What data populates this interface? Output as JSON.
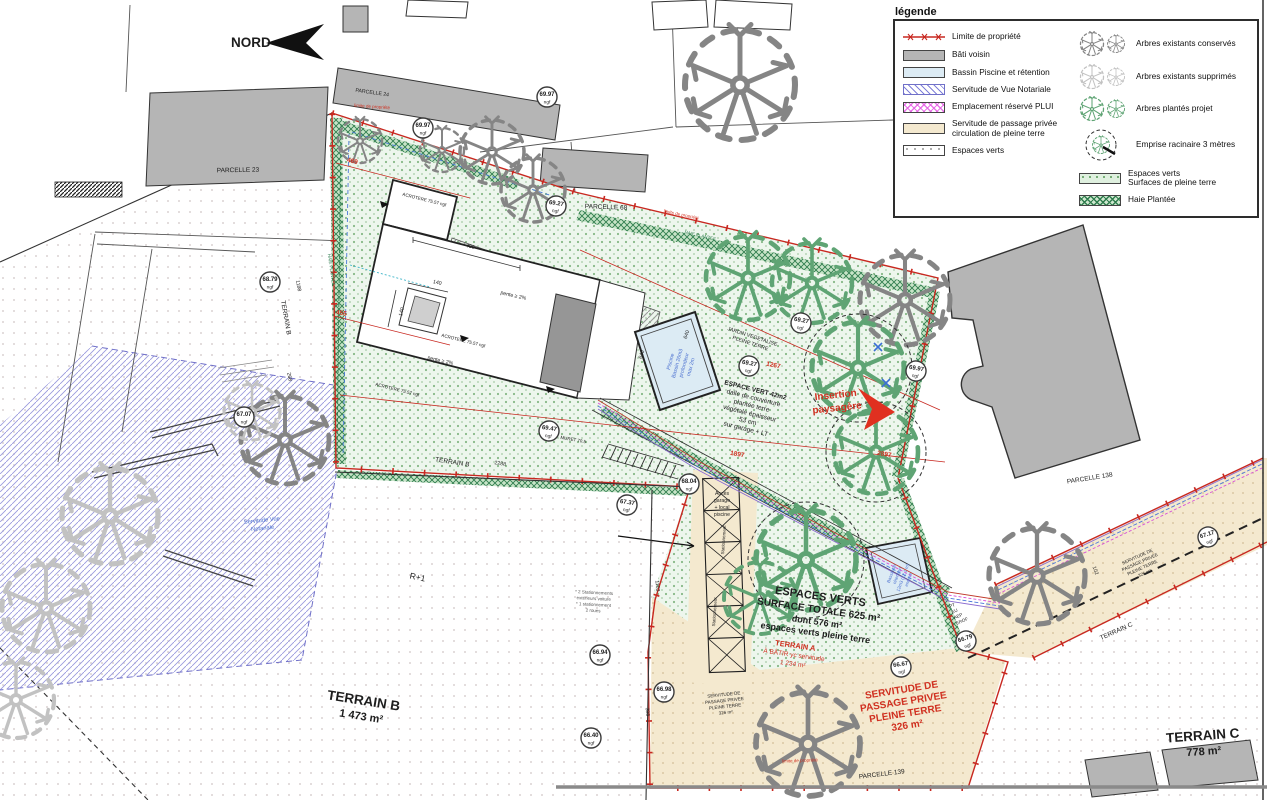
{
  "colors": {
    "boundary": "#c82820",
    "red_text": "#d03020",
    "mint": "#edf6ed",
    "dot_green": "#74ad74",
    "haie": "#2f7d4e",
    "haie_bg": "#c7e4c7",
    "beige": "#f4e9cf",
    "bati": "#b5b5b5",
    "bassin": "#dcebf4",
    "vue": "#8080d0",
    "plui": "#e55ce5",
    "blue_text": "#4a6fd0",
    "dash_blue": "#4a78d8",
    "magenta": "#d84fd8",
    "purple": "#8a6ad0",
    "gray_line": "#555"
  },
  "north": {
    "label": "NORD"
  },
  "legend": {
    "title": "légende",
    "left": [
      {
        "label": "Limite de propriété"
      },
      {
        "label": "Bâti voisin"
      },
      {
        "label": "Bassin Piscine et rétention"
      },
      {
        "label": "Servitude de Vue Notariale"
      },
      {
        "label": "Emplacement réservé PLUI"
      },
      {
        "label": "Servitude de passage privée\ncirculation de pleine terre"
      },
      {
        "label": "Espaces verts"
      }
    ],
    "right": [
      {
        "label": "Arbres existants conservés"
      },
      {
        "label": "Arbres existants supprimés"
      },
      {
        "label": "Arbres plantés projet"
      },
      {
        "label": "Emprise racinaire 3 mètres"
      },
      {
        "label": "Espaces verts\nSurfaces de pleine terre"
      },
      {
        "label": "Haie Plantée"
      }
    ]
  },
  "parcelles": {
    "p23": "PARCELLE 23",
    "p24": "PARCELLE 24",
    "p68": "PARCELLE 68",
    "p138": "PARCELLE 138",
    "p139": "PARCELLE 139"
  },
  "terrains": {
    "a": [
      "TERRAIN A",
      "À BÂTIR yc servitude",
      "1 234 m²"
    ],
    "b_big": [
      "TERRAIN B",
      "1 473 m²"
    ],
    "c_big": [
      "TERRAIN C",
      "778 m²"
    ],
    "b_side": "TERRAIN B",
    "b_edge": "TERRAIN B",
    "c_edge": "TERRAIN C"
  },
  "blocks": {
    "espaces_verts": [
      "ESPACES VERTS",
      "SURFACE TOTALE 625 m²",
      "dont 576 m²",
      "espaces verts pleine terre"
    ],
    "servitude_red": [
      "SERVITUDE DE",
      "PASSAGE PRIVEE",
      "PLEINE TERRE",
      "326 m²"
    ],
    "servitude_small": [
      "SERVITUDE DE",
      "PASSAGE PRIVEE",
      "PLEINE TERRE",
      "326 m²"
    ],
    "servitude_corridor": [
      "SERVITUDE DE",
      "PASSAGE PRIVEE",
      "PLEINE TERRE",
      "326 m²"
    ],
    "espace_vert_42": [
      "ESPACE VERT 42m2",
      "dalle de couverture",
      "plantée terre",
      "végétale épaisseur",
      "53 cm",
      "sur garage + LT"
    ],
    "jardin": [
      "JARDIN VEGETALISE",
      "PLEINE TERRE"
    ],
    "insertion": [
      "Insertion",
      "paysagère"
    ],
    "acces": [
      "Accès",
      "garage",
      "+ local",
      "piscine"
    ],
    "bassin_piscine": [
      "Piscine",
      "Bassin 26m3",
      "profondeur",
      "max 2m"
    ],
    "bassin_retention": [
      "Bassin de",
      "rétention",
      "12m3 (12.1 m)",
      "enterré"
    ],
    "servitude_vue": [
      "Servitude Vue",
      "Notariale"
    ],
    "parking_note": [
      "* 2 Stationnements",
      "extérieurs voiture",
      "* 1 stationnement",
      "2 roues"
    ]
  },
  "labels": {
    "limite": "limite de propriété",
    "haie": "HAIE PLANTEE",
    "acrotere": "ACROTERE 75.57 ngf",
    "pente": "pente ≥ 2%",
    "muret": "MURET 70.5",
    "r1": "R+1",
    "stationnement": "Stationnement",
    "pt": "PT",
    "eu": "EU",
    "aep": "AEP",
    "erdf": "EROF"
  },
  "dims": {
    "d469": "469",
    "d455": "455",
    "d1267": "1267",
    "d1897": "1897",
    "d2897": "2897",
    "d430": "430",
    "d140a": "140",
    "d140b": "140",
    "d2288": "2288",
    "d1188": "1188",
    "d268": "268",
    "d1103": "1103",
    "d398": "398",
    "d640a": "640",
    "d640b": "640",
    "d102": "102"
  },
  "elevations": {
    "unit": "ngf",
    "e1": "69.97",
    "e2": "69.97",
    "e3": "69.27",
    "e4": "69.27",
    "e5": "69.27",
    "e6": "69.97",
    "e7": "68.79",
    "e8": "67.07",
    "e9": "69.47",
    "e10": "67.37",
    "e11": "66.94",
    "e12": "68.04",
    "e13": "66.98",
    "e14": "66.40",
    "e15": "66.67",
    "e16": "66.79",
    "e17": "67.17"
  }
}
